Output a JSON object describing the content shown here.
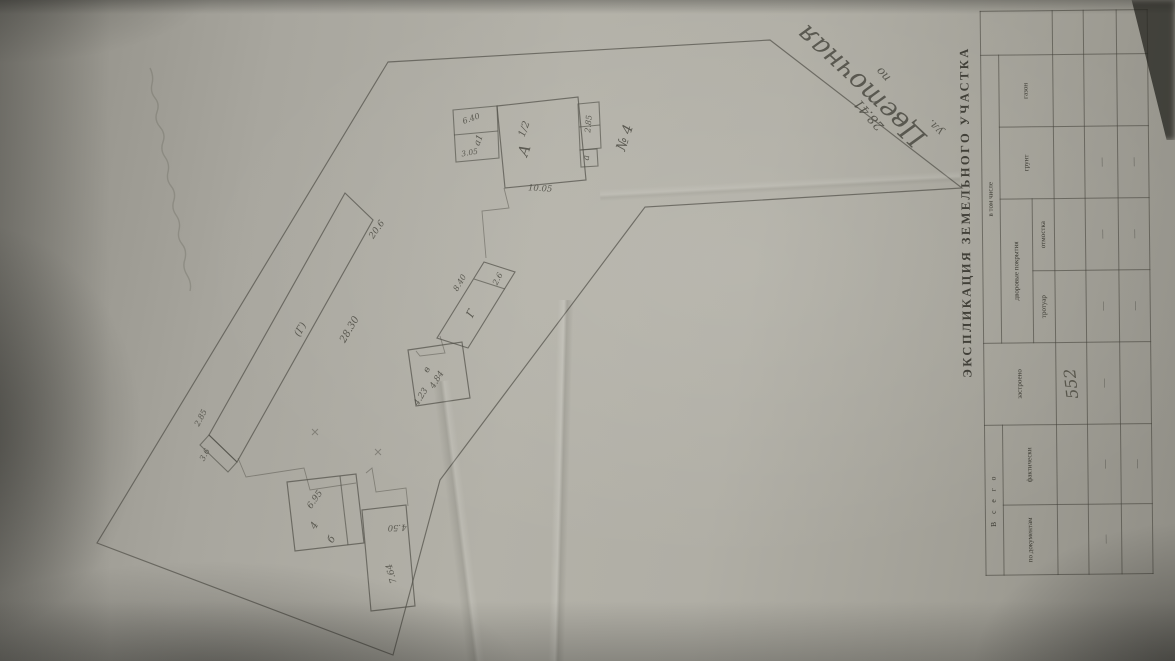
{
  "table": {
    "title": "ЭКСПЛИКАЦИЯ ЗЕМЕЛЬНОГО УЧАСТКА",
    "group_total": "В с е г о",
    "group_including": "в том числе",
    "group_pavings": "дворовые покрытия",
    "col_by_documents": "по докумен­там",
    "col_actual": "фактически",
    "col_built": "застроено",
    "col_sidewalk": "тротуар",
    "col_blind_area": "отмостка",
    "col_soil": "грунт",
    "col_lawn": "газон",
    "rows": [
      [
        "",
        "",
        "552",
        "",
        "",
        "",
        ""
      ],
      [
        "—",
        "—",
        "—",
        "—",
        "—",
        "—",
        ""
      ],
      [
        "",
        "—",
        "",
        "—",
        "—",
        "—",
        ""
      ]
    ]
  },
  "plan": {
    "street_prefix": "ул.",
    "street_name": "Цветочная",
    "frontage_label": "по",
    "frontage_value": "28.41",
    "house": {
      "letter": "А",
      "storeys": "1/2",
      "number": "№ 4",
      "dim_bottom": "10.05",
      "annex_left_letter": "а1",
      "annex_left_dim": "6.40",
      "annex_left_dim2": "3.05",
      "annex_right_letter": "а",
      "annex_right_dim": "2.85"
    },
    "shed_long": {
      "letter": "(Г)",
      "dim_length": "28.30",
      "dim_end": "20.6",
      "dim_end2": "2.85",
      "dim_end3": "3.6"
    },
    "shed_mid": {
      "letter": "Г",
      "dim": "8.40",
      "dim_top": "2.6"
    },
    "shed_square": {
      "letter": "в",
      "dim": "4.84",
      "dim2": "4.23"
    },
    "barn": {
      "letter": "б",
      "dim": "6.95",
      "dim2": "4"
    },
    "shed_narrow": {
      "dim_top": "4.50",
      "dim_side": "7.64"
    }
  }
}
